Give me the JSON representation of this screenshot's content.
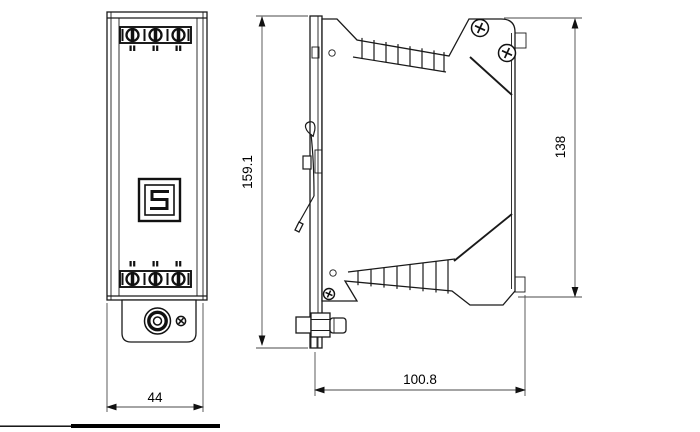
{
  "title": "Dimensional drawing - DIN-rail device, front and side view",
  "colors": {
    "line": "#1a1a1a",
    "dim_line": "#4a4a4a",
    "background": "#ffffff"
  },
  "dims": {
    "overall_height": {
      "label": "159.1",
      "orientation": "vertical",
      "side": "left-of-side-view"
    },
    "body_height": {
      "label": "138",
      "orientation": "vertical",
      "side": "right-of-side-view"
    },
    "depth": {
      "label": "100.8",
      "orientation": "horizontal",
      "side": "below-side-view"
    },
    "width": {
      "label": "44",
      "orientation": "horizontal",
      "side": "below-front-view"
    }
  },
  "front_view": {
    "terminal_blocks": [
      {
        "position": "top",
        "screw_terminals": 3,
        "marker_glyph": "▪"
      },
      {
        "position": "bottom",
        "screw_terminals": 3,
        "marker_glyph": "▪"
      }
    ],
    "logo_glyph": "S",
    "bottom_connector": "coaxial-socket",
    "bottom_screw_count": 1
  },
  "side_view": {
    "din_rail_clip": true,
    "vent_bands": 2,
    "vent_ribs_per_band": 8,
    "phillips_screws": 3,
    "holes": 2,
    "side_connector": "coaxial-socket"
  }
}
